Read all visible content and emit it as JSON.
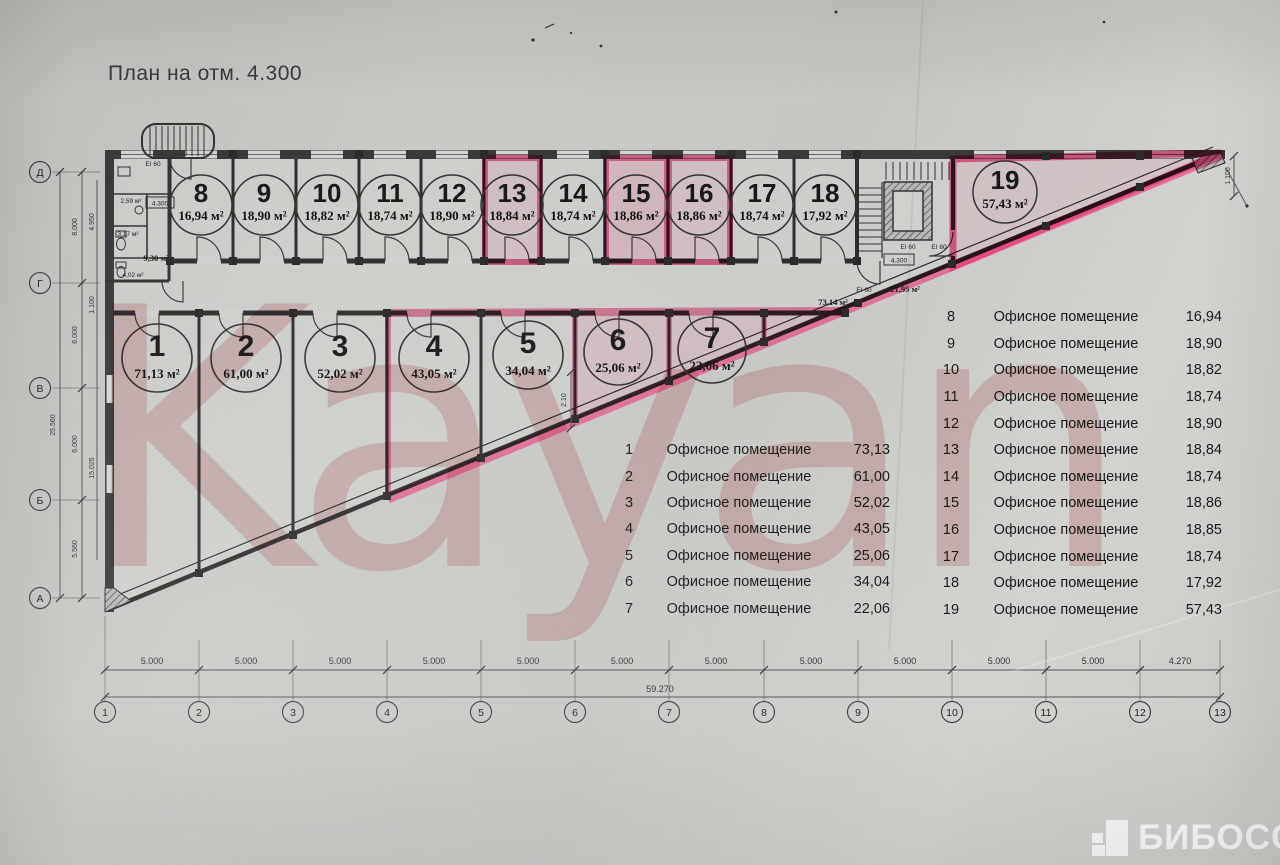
{
  "title": "План на отм. 4.300",
  "watermark": "Kayan",
  "logo": {
    "text": "БИБОСС"
  },
  "colors": {
    "highlight": "#e8417f",
    "ink": "#2e2e2e",
    "paper": "#c9cac5",
    "watermark": "#c22b3d"
  },
  "rooms": [
    {
      "num": "1",
      "area": "71,13 м²"
    },
    {
      "num": "2",
      "area": "61,00 м²"
    },
    {
      "num": "3",
      "area": "52,02 м²"
    },
    {
      "num": "4",
      "area": "43,05 м²"
    },
    {
      "num": "5",
      "area": "34,04 м²"
    },
    {
      "num": "6",
      "area": "25,06 м²"
    },
    {
      "num": "7",
      "area": "22,06 м²"
    },
    {
      "num": "8",
      "area": "16,94 м²"
    },
    {
      "num": "9",
      "area": "18,90 м²"
    },
    {
      "num": "10",
      "area": "18,82 м²"
    },
    {
      "num": "11",
      "area": "18,74 м²"
    },
    {
      "num": "12",
      "area": "18,90 м²"
    },
    {
      "num": "13",
      "area": "18,84 м²"
    },
    {
      "num": "14",
      "area": "18,74 м²"
    },
    {
      "num": "15",
      "area": "18,86 м²"
    },
    {
      "num": "16",
      "area": "18,86 м²"
    },
    {
      "num": "17",
      "area": "18,74 м²"
    },
    {
      "num": "18",
      "area": "17,92 м²"
    },
    {
      "num": "19",
      "area": "57,43 м²"
    }
  ],
  "tables": {
    "left": {
      "rows": [
        {
          "num": "1",
          "name": "Офисное помещение",
          "area": "73,13"
        },
        {
          "num": "2",
          "name": "Офисное помещение",
          "area": "61,00"
        },
        {
          "num": "3",
          "name": "Офисное помещение",
          "area": "52,02"
        },
        {
          "num": "4",
          "name": "Офисное помещение",
          "area": "43,05"
        },
        {
          "num": "5",
          "name": "Офисное помещение",
          "area": "25,06"
        },
        {
          "num": "6",
          "name": "Офисное помещение",
          "area": "34,04"
        },
        {
          "num": "7",
          "name": "Офисное помещение",
          "area": "22,06"
        }
      ]
    },
    "right": {
      "rows": [
        {
          "num": "8",
          "name": "Офисное помещение",
          "area": "16,94"
        },
        {
          "num": "9",
          "name": "Офисное помещение",
          "area": "18,90"
        },
        {
          "num": "10",
          "name": "Офисное помещение",
          "area": "18,82"
        },
        {
          "num": "11",
          "name": "Офисное помещение",
          "area": "18,74"
        },
        {
          "num": "12",
          "name": "Офисное помещение",
          "area": "18,90"
        },
        {
          "num": "13",
          "name": "Офисное помещение",
          "area": "18,84"
        },
        {
          "num": "14",
          "name": "Офисное помещение",
          "area": "18,74"
        },
        {
          "num": "15",
          "name": "Офисное помещение",
          "area": "18,86"
        },
        {
          "num": "16",
          "name": "Офисное помещение",
          "area": "18,85"
        },
        {
          "num": "17",
          "name": "Офисное помещение",
          "area": "18,74"
        },
        {
          "num": "18",
          "name": "Офисное помещение",
          "area": "17,92"
        },
        {
          "num": "19",
          "name": "Офисное помещение",
          "area": "57,43"
        }
      ]
    }
  },
  "axes": {
    "bottom": {
      "labels": [
        "1",
        "2",
        "3",
        "4",
        "5",
        "6",
        "7",
        "8",
        "9",
        "10",
        "11",
        "12",
        "13"
      ],
      "bays": [
        "5.000",
        "5.000",
        "5.000",
        "5.000",
        "5.000",
        "5.000",
        "5.000",
        "5.000",
        "5.000",
        "5.000",
        "5.000",
        "4.270"
      ],
      "total": "59.270"
    },
    "left": {
      "labels": [
        "Д",
        "Г",
        "В",
        "Б",
        "А"
      ],
      "bays": [
        "8.000",
        "6.000",
        "6.000",
        "5.560"
      ],
      "inner": [
        "4.950",
        "1.100",
        "15.025"
      ],
      "total": "25.560"
    }
  },
  "annotations": {
    "level_a": "4.300",
    "level_b": "4.300",
    "corridor": "73,14 м²",
    "hall": "21,95 м²",
    "wc_1": "2,59 м²",
    "wc_2": "3,17 м²",
    "wc_3": "9,30 м²",
    "wc_4": "4,02 м²",
    "ei_1": "EI 60",
    "ei_2": "EI 60",
    "ei_3": "EI 60",
    "ei_4": "EI 60",
    "dim_a": "2.10",
    "dim_b": "1.100"
  }
}
